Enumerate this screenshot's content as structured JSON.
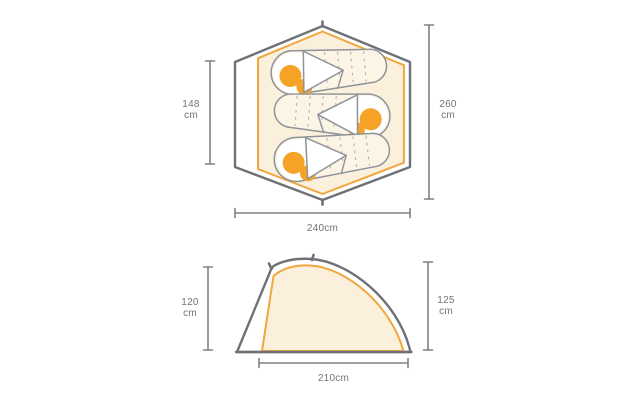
{
  "diagram": {
    "type": "tent-dimensions",
    "top_view": {
      "sleeping_bag_count": 3,
      "height_left": {
        "value": "148",
        "unit": "cm"
      },
      "height_right": {
        "value": "260",
        "unit": "cm"
      },
      "width_bottom": "240cm"
    },
    "side_view": {
      "height_left": {
        "value": "120",
        "unit": "cm"
      },
      "height_right": {
        "value": "125",
        "unit": "cm"
      },
      "width_bottom": "210cm"
    }
  },
  "colors": {
    "background": "#ffffff",
    "outline_gray": "#6E7277",
    "bag_gray": "#8F939A",
    "dim_gray": "#7D8187",
    "text_gray": "#707478",
    "accent_orange": "#F1A63E",
    "fill_cream": "#FBF0DB",
    "bag_fill": "#FCF4E4",
    "pillow_orange": "#F5A226"
  }
}
